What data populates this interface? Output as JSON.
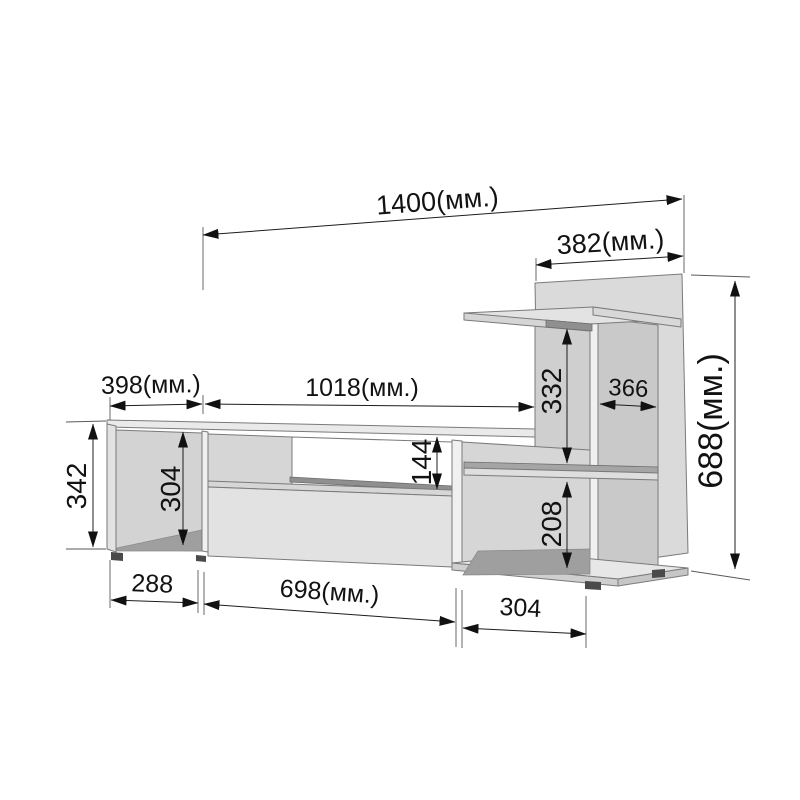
{
  "drawing": {
    "type": "furniture-dimension-diagram",
    "subject": "TV stand wall unit with side shelf tower",
    "unit": "мм",
    "dims": {
      "overall_width": "1400(мм.)",
      "tower_width": "382(мм.)",
      "tower_height": "688(мм.)",
      "left_top_width": "398(мм.)",
      "top_span_width": "1018(мм.)",
      "tower_depth": "366",
      "upper_shelf_gap": "332",
      "lower_shelf_gap": "208",
      "niche_height": "144",
      "left_height": "342",
      "left_inner_height": "304",
      "bottom_left_width": "288",
      "bottom_center_width": "698(мм.)",
      "bottom_right_width": "304"
    },
    "colors": {
      "background": "#ffffff",
      "face_light": "#eaeaea",
      "face_mid": "#d5d5d5",
      "face_dark": "#9f9f9f",
      "edge": "#7a7a7a",
      "dimension": "#1c1c1c"
    }
  }
}
